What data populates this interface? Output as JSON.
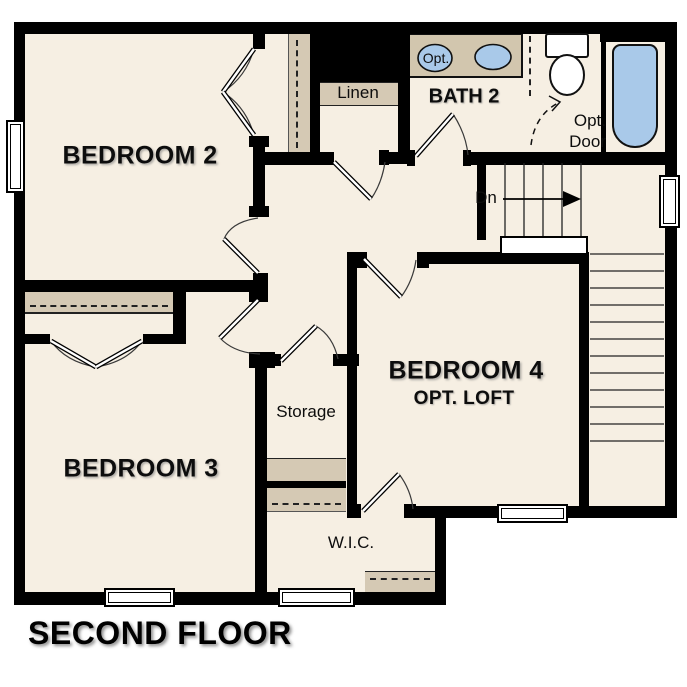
{
  "floorplan": {
    "title": "SECOND FLOOR",
    "rooms": {
      "bedroom2": {
        "label": "BEDROOM 2"
      },
      "bedroom3": {
        "label": "BEDROOM 3"
      },
      "bedroom4": {
        "label": "BEDROOM 4",
        "sublabel": "OPT. LOFT"
      },
      "bath2": {
        "label": "BATH 2"
      },
      "linen": {
        "label": "Linen"
      },
      "storage": {
        "label": "Storage"
      },
      "wic": {
        "label": "W.I.C."
      }
    },
    "annotations": {
      "stairs_down": "Dn",
      "opt_door_line1": "Opt.",
      "opt_door_line2": "Door",
      "opt_sink": "Opt."
    },
    "colors": {
      "wall": "#000000",
      "floor": "#f6efe3",
      "closet_shelf": "#d5c9b4",
      "fixture_blue": "#a9c9e9",
      "outside": "#ffffff"
    }
  }
}
